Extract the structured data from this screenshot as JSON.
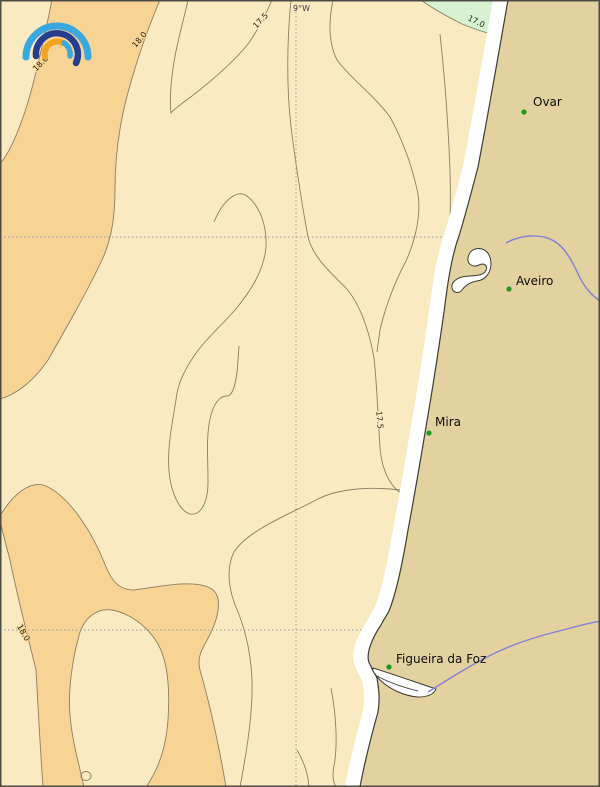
{
  "map": {
    "meridian_label": "9°W",
    "isotherms": {
      "label_18_west": "18.0",
      "label_18_mid": "18.0",
      "label_175_north": "17.5",
      "label_17_northeast": "17.0",
      "label_175_mira": "17.5",
      "label_18_southwest": "18.0"
    },
    "cities": [
      {
        "name": "Ovar"
      },
      {
        "name": "Aveiro"
      },
      {
        "name": "Mira"
      },
      {
        "name": "Figueira da Foz"
      }
    ]
  },
  "colors": {
    "sea_17_18": "#FAEAC1",
    "sea_above_18": "#F8D494",
    "sea_below_17": "#D6F2CE",
    "land": "#E3D1A0",
    "contour_line": "#8A7F63",
    "coastline": "#3F3D33",
    "gridline": "#9A9A9A",
    "river": "#8381D8",
    "coastal_strip": "#FFFFFF",
    "city_dot": "#1F9B23",
    "city_label": "#0D0D0D",
    "contour_label": "#262619",
    "frame": "#4C4C45",
    "logo_cyan": "#39A8DF",
    "logo_navy": "#253E8F",
    "logo_orange": "#F5A21F"
  }
}
